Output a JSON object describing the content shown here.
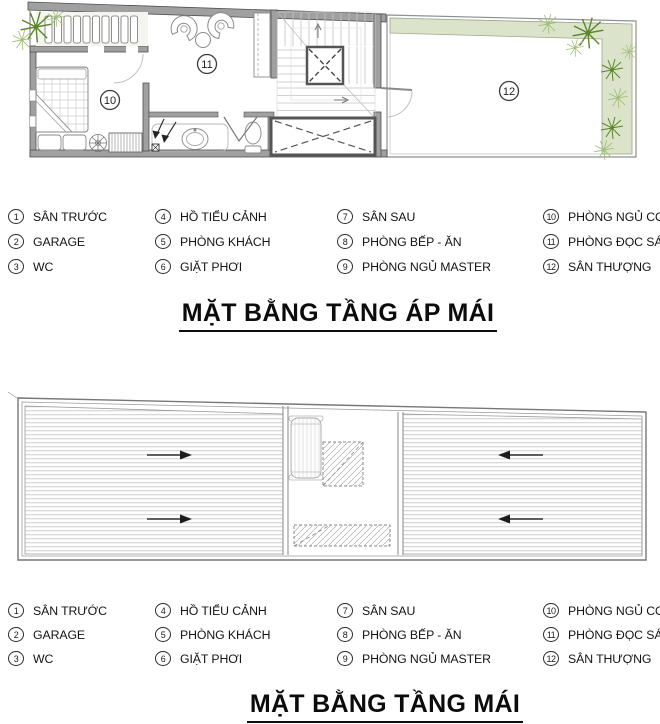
{
  "titles": {
    "attic": "MẶT BẰNG TẦNG ÁP MÁI",
    "roof": "MẶT BẰNG TẦNG MÁI"
  },
  "room_labels": {
    "bedroom_child": "10",
    "reading_room": "11",
    "terrace": "12"
  },
  "legend": {
    "items": [
      {
        "num": "1",
        "label": "SÂN TRƯỚC"
      },
      {
        "num": "2",
        "label": "GARAGE"
      },
      {
        "num": "3",
        "label": "WC"
      },
      {
        "num": "4",
        "label": "HỒ TIỂU CẢNH"
      },
      {
        "num": "5",
        "label": "PHÒNG KHÁCH"
      },
      {
        "num": "6",
        "label": "GIẶT PHƠI"
      },
      {
        "num": "7",
        "label": "SÂN SAU"
      },
      {
        "num": "8",
        "label": "PHÒNG BẾP - ĂN"
      },
      {
        "num": "9",
        "label": "PHÒNG NGỦ MASTER"
      },
      {
        "num": "10",
        "label": "PHÒNG NGỦ CON"
      },
      {
        "num": "11",
        "label": "PHÒNG ĐỌC SÁCH"
      },
      {
        "num": "12",
        "label": "SÂN THƯỢNG"
      }
    ]
  },
  "colors": {
    "wall_fill": "#a0a0a0",
    "wall_edge": "#4f4f4f",
    "planter_fill": "#dbe4ca",
    "plant_dark": "#5c8527",
    "plant_light": "#a3bf77",
    "paper": "#ffffff",
    "text": "#111111"
  }
}
